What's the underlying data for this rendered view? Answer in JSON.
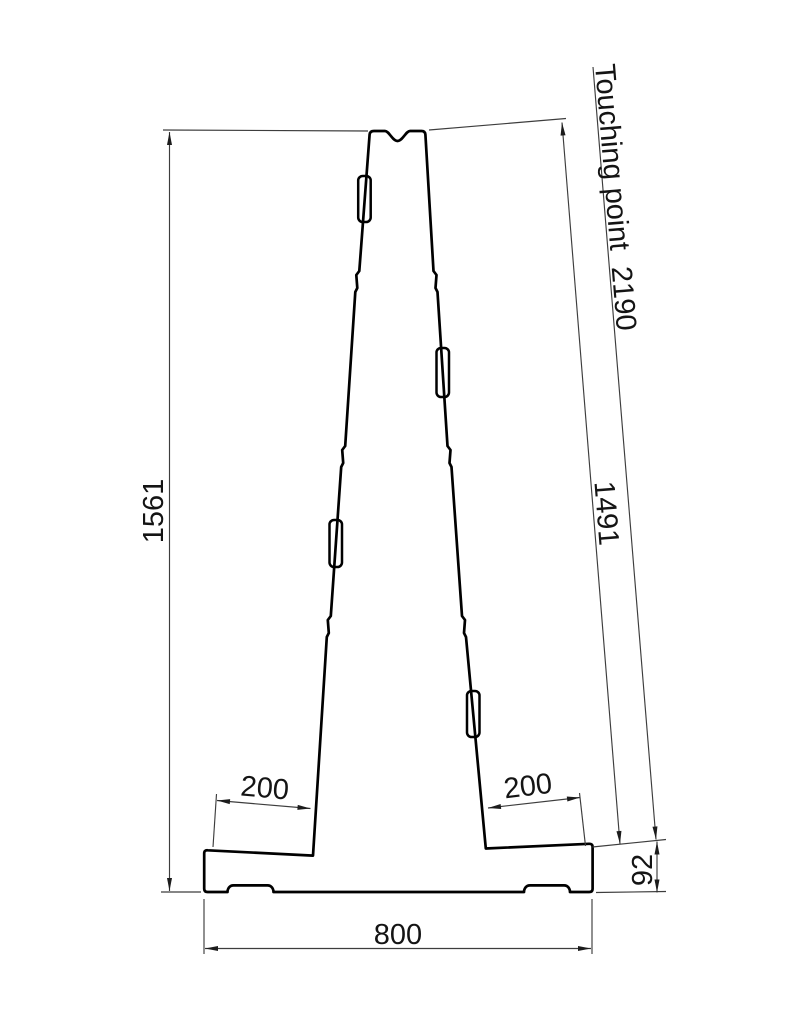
{
  "drawing": {
    "dim_height_total": "1561",
    "dim_touching_point": "Touching point  2190",
    "dim_diagonal": "1491",
    "dim_left_flange": "200",
    "dim_right_flange": "200",
    "dim_base_height": "92",
    "dim_base_width": "800"
  }
}
